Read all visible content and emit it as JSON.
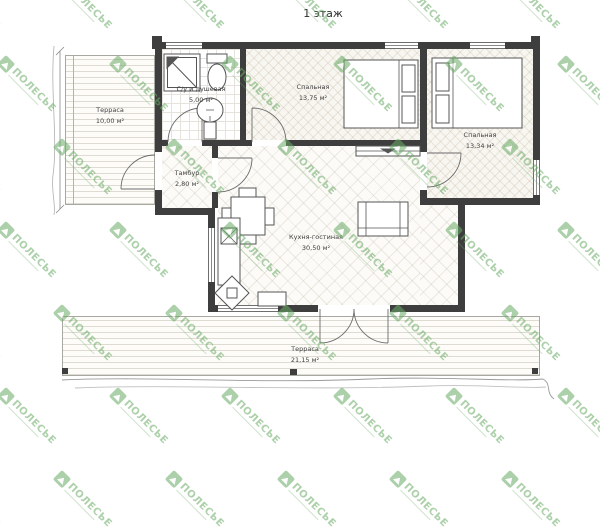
{
  "title": "1 этаж",
  "watermark": {
    "text": "ПОЛЕСЬЕ"
  },
  "colors": {
    "wall": "#3e3e3e",
    "label": "#3f3f3f",
    "watermark_green": "#6aab66",
    "line": "#666666"
  },
  "rooms": [
    {
      "id": "terrace-left",
      "name": "Терраса",
      "area": "10,00 м²"
    },
    {
      "id": "bathroom",
      "name": "С/у и душевая",
      "area": "5,00 м²"
    },
    {
      "id": "bedroom-1",
      "name": "Спальная",
      "area": "13,75 м²"
    },
    {
      "id": "bedroom-2",
      "name": "Спальная",
      "area": "13,34 м²"
    },
    {
      "id": "vestibule",
      "name": "Тамбур",
      "area": "2,80 м²"
    },
    {
      "id": "kitchen-living",
      "name": "Кухня-гостиная",
      "area": "30,50 м²"
    },
    {
      "id": "terrace-bottom",
      "name": "Терраса",
      "area": "21,15 м²"
    }
  ],
  "furniture": [
    "shower",
    "toilet",
    "sink",
    "double-bed",
    "double-bed",
    "dining-table",
    "sofa",
    "tv-stand",
    "kitchen-counter",
    "kitchen-sink",
    "corner-stove",
    "counter"
  ]
}
